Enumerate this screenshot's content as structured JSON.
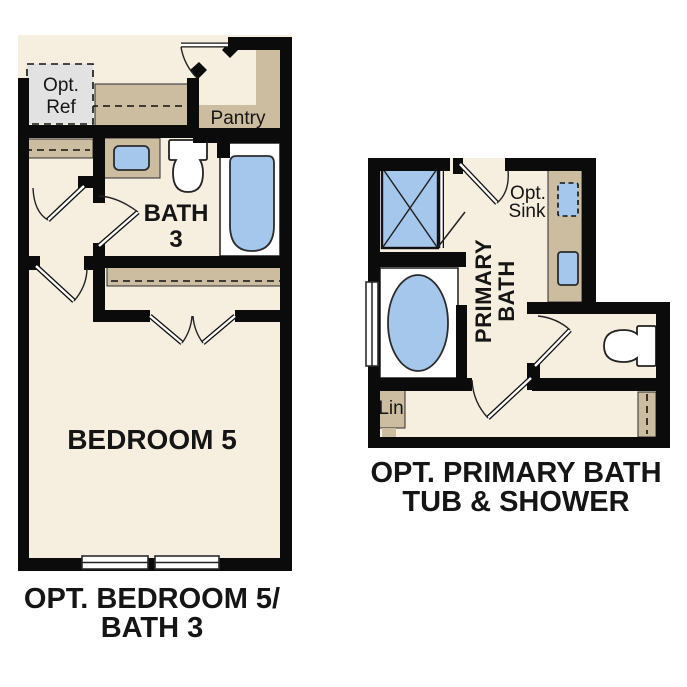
{
  "title": "Optional floor plan options",
  "colors": {
    "floor": "#F6EEDF",
    "counter": "#CCBDA0",
    "fixture": "#A6C7EC",
    "optbox": "#E2E2E2",
    "wall": "#0B0B0B",
    "outline": "#2B2B2B"
  },
  "left_plan": {
    "name": "Opt. Bedroom 5 / Bath 3 option",
    "labels": {
      "opt_ref": [
        "Opt.",
        "Ref"
      ],
      "pantry": "Pantry",
      "bath3": [
        "BATH",
        "3"
      ],
      "bedroom": "BEDROOM 5"
    },
    "caption": [
      "OPT. BEDROOM 5/",
      "BATH 3"
    ]
  },
  "right_plan": {
    "name": "Opt. Primary Bath Tub & Shower option",
    "labels": {
      "opt_sink": [
        "Opt.",
        "Sink"
      ],
      "primary_bath": [
        "PRIMARY",
        "BATH"
      ],
      "linen": "Lin"
    },
    "caption": [
      "OPT. PRIMARY BATH",
      "TUB & SHOWER"
    ]
  }
}
